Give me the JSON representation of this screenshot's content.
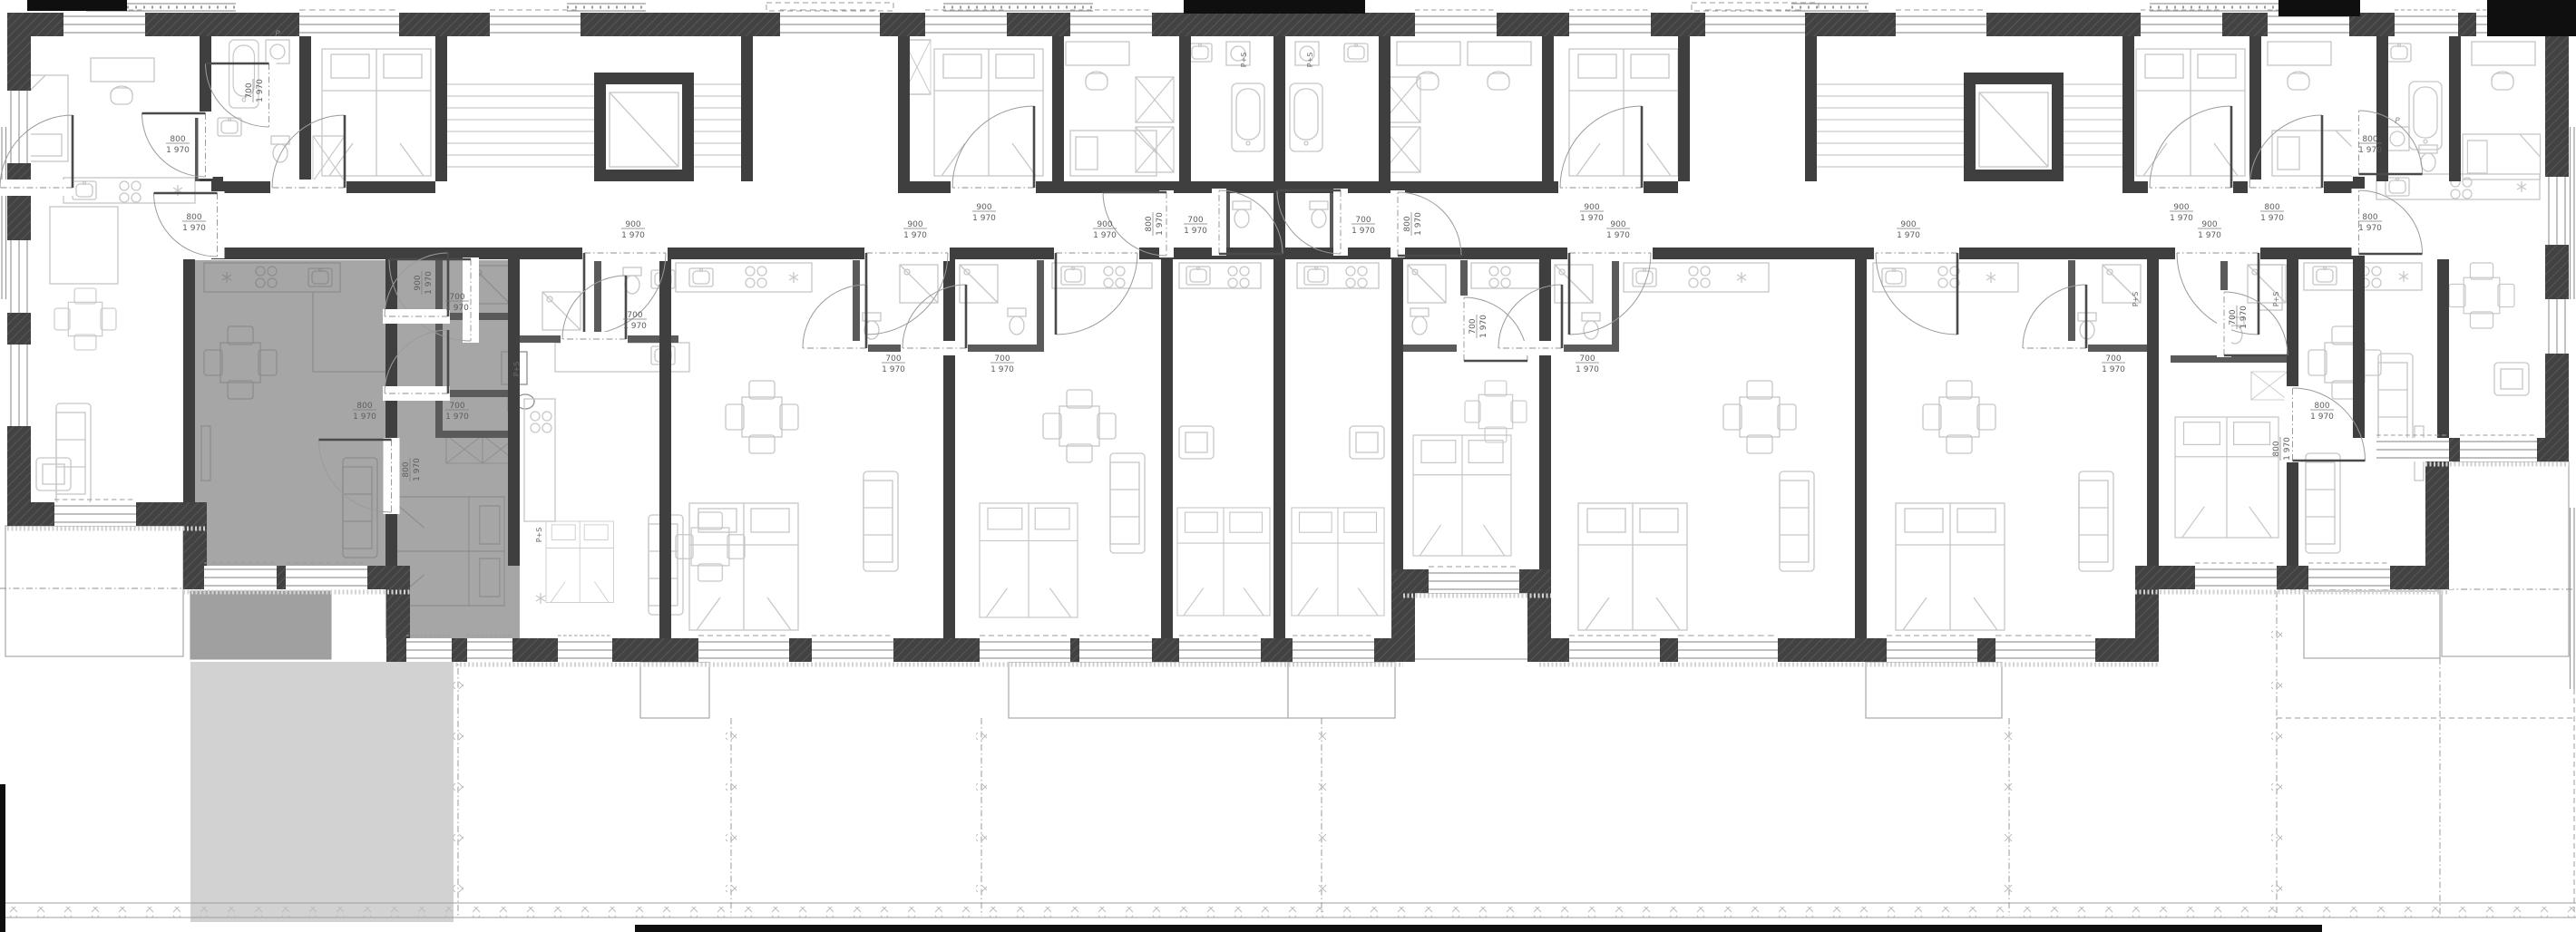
{
  "plan": {
    "dimension_labels": {
      "w700": "700",
      "w800": "800",
      "w900": "900",
      "height": "1 970"
    },
    "appliance_labels": {
      "washer_dryer": "P+S",
      "washer": "P"
    },
    "colors": {
      "paper": "#ffffff",
      "wall": "#3f3f3f",
      "wall_hatch": "#565656",
      "partition": "#5a5a5a",
      "furniture": "#c7c7c7",
      "furniture_highlight": "#8d8d8d",
      "highlight_unit": "#a6a6a6",
      "highlight_terrace": "#a0a0a0",
      "highlight_garden": "#d2d2d2",
      "dim_text": "#5c5c5c",
      "site_line": "#9d9d9d",
      "fence_mark": "#bdbdbd",
      "black": "#0f0f0f"
    }
  }
}
